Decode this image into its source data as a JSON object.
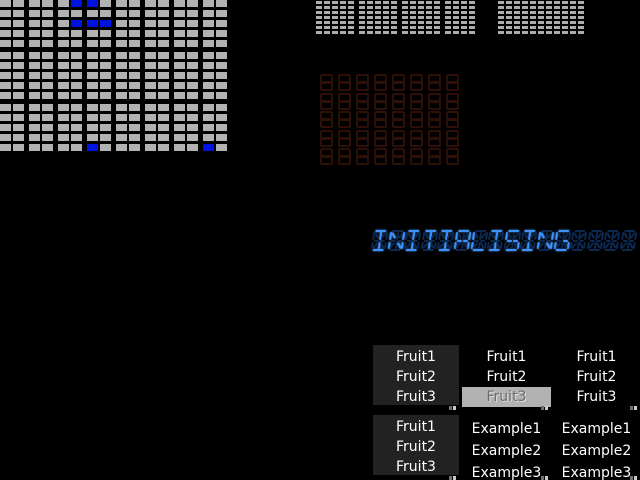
{
  "canvas": {
    "bg": "#000000"
  },
  "big_grid": {
    "rows": 15,
    "cols": 16,
    "cell_color": "#b2b2b2",
    "active_color": "#0012e0",
    "active_cells": [
      [
        0,
        5
      ],
      [
        0,
        6
      ],
      [
        2,
        5
      ],
      [
        2,
        6
      ],
      [
        2,
        7
      ],
      [
        14,
        6
      ],
      [
        14,
        14
      ]
    ]
  },
  "small_grids": {
    "cell_color": "#adadad",
    "rows": 7,
    "groups": [
      {
        "cols": 5
      },
      {
        "cols": 5
      },
      {
        "cols": 5
      },
      {
        "cols": 4
      },
      {
        "cols": 11
      }
    ]
  },
  "sevenseg_panel": {
    "cols": 8,
    "rows": 5,
    "segment_color": "#2e0f06"
  },
  "segment_display": {
    "text": "INITIALISING",
    "cells": 16,
    "lit_color": "#3a93ff",
    "unlit_color": "#0c2850"
  },
  "listboxes": [
    {
      "name": "fruit-list-1",
      "bg": "#222222",
      "selected": -1,
      "highlight": "#b2b2b2",
      "items": [
        "Fruit1",
        "Fruit2",
        "Fruit3"
      ]
    },
    {
      "name": "fruit-list-2",
      "bg": "#000000",
      "selected": 2,
      "highlight": "#b2b2b2",
      "items": [
        "Fruit1",
        "Fruit2",
        "Fruit3"
      ]
    },
    {
      "name": "fruit-list-3",
      "bg": "#000000",
      "selected": -1,
      "highlight": "#b2b2b2",
      "items": [
        "Fruit1",
        "Fruit2",
        "Fruit3"
      ]
    },
    {
      "name": "fruit-list-4",
      "bg": "#222222",
      "selected": -1,
      "highlight": "#b2b2b2",
      "items": [
        "Fruit1",
        "Fruit2",
        "Fruit3"
      ]
    },
    {
      "name": "example-list-1",
      "bg": "#000000",
      "selected": -1,
      "highlight": "#b2b2b2",
      "items": [
        "Example1",
        "Example2",
        "Example3"
      ]
    },
    {
      "name": "example-list-2",
      "bg": "#000000",
      "selected": -1,
      "highlight": "#b2b2b2",
      "items": [
        "Example1",
        "Example2",
        "Example3"
      ]
    }
  ],
  "grip_colors": {
    "dark": "#6f6f6f",
    "light": "#c8c8c8"
  }
}
